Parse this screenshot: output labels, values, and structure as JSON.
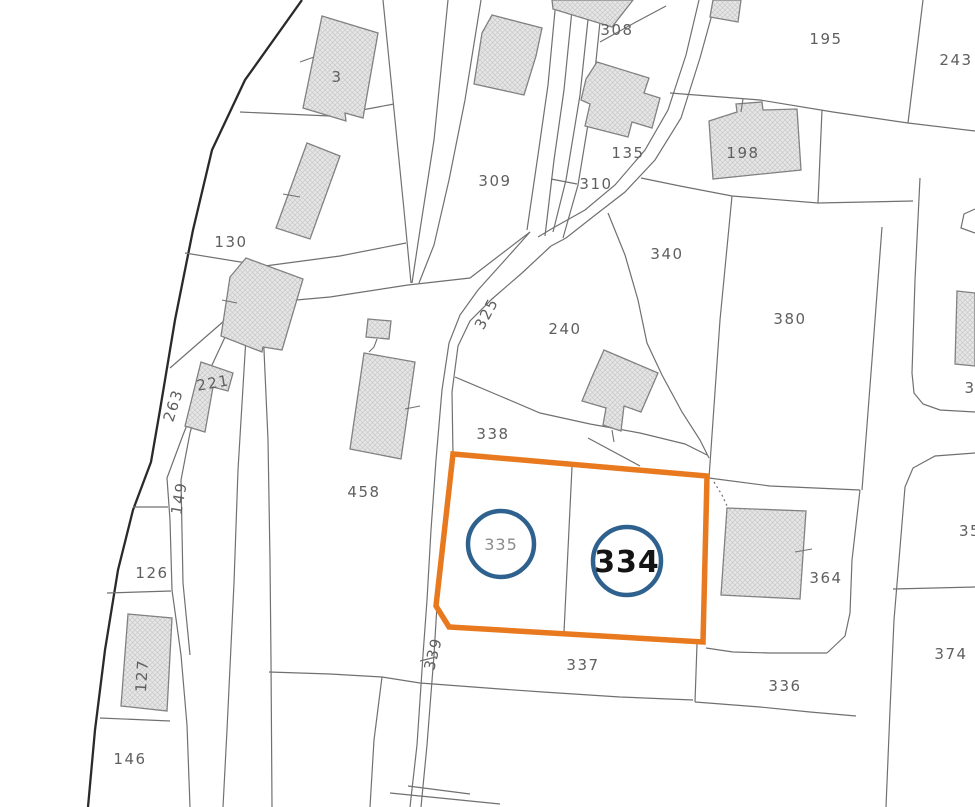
{
  "map": {
    "kind": "cadastral-parcel-map",
    "colors": {
      "background": "#ffffff",
      "parcel_line": "#707070",
      "outer_boundary": "#2a2a2a",
      "building_fill": "#e6e6e6",
      "building_hatch": "#c9c9c9",
      "building_stroke": "#818181",
      "label_gray": "#5f5f5f",
      "highlight_orange": "#e8791e",
      "circle_blue": "#2f618f"
    },
    "selection": {
      "primary_parcel": "334",
      "secondary_parcel": "335",
      "highlight_shape": "orange-boundary-polygon"
    },
    "parcel_labels": [
      {
        "text": "3",
        "x": 337,
        "y": 82,
        "rot": 0
      },
      {
        "text": "130",
        "x": 231,
        "y": 247,
        "rot": 0
      },
      {
        "text": "308",
        "x": 617,
        "y": 35,
        "rot": 0
      },
      {
        "text": "195",
        "x": 826,
        "y": 44,
        "rot": 0
      },
      {
        "text": "243",
        "x": 956,
        "y": 65,
        "rot": 0
      },
      {
        "text": "198",
        "x": 743,
        "y": 158,
        "rot": 0
      },
      {
        "text": "135",
        "x": 628,
        "y": 158,
        "rot": 0
      },
      {
        "text": "309",
        "x": 495,
        "y": 186,
        "rot": 0
      },
      {
        "text": "310",
        "x": 596,
        "y": 189,
        "rot": 0
      },
      {
        "text": "340",
        "x": 667,
        "y": 259,
        "rot": 0
      },
      {
        "text": "380",
        "x": 790,
        "y": 324,
        "rot": 0
      },
      {
        "text": "240",
        "x": 565,
        "y": 334,
        "rot": 0
      },
      {
        "text": "325",
        "x": 491,
        "y": 316,
        "rot": -62
      },
      {
        "text": "338",
        "x": 493,
        "y": 439,
        "rot": 0
      },
      {
        "text": "263",
        "x": 178,
        "y": 407,
        "rot": -72
      },
      {
        "text": "221",
        "x": 214,
        "y": 388,
        "rot": -10
      },
      {
        "text": "149",
        "x": 184,
        "y": 499,
        "rot": -80
      },
      {
        "text": "458",
        "x": 364,
        "y": 497,
        "rot": 0
      },
      {
        "text": "126",
        "x": 152,
        "y": 578,
        "rot": 0
      },
      {
        "text": "127",
        "x": 147,
        "y": 676,
        "rot": -86
      },
      {
        "text": "146",
        "x": 130,
        "y": 764,
        "rot": 0
      },
      {
        "text": "364",
        "x": 826,
        "y": 583,
        "rot": 0
      },
      {
        "text": "339",
        "x": 438,
        "y": 655,
        "rot": -76
      },
      {
        "text": "337",
        "x": 583,
        "y": 670,
        "rot": 0
      },
      {
        "text": "336",
        "x": 785,
        "y": 691,
        "rot": 0
      },
      {
        "text": "374",
        "x": 951,
        "y": 659,
        "rot": 0
      },
      {
        "text": "35",
        "x": 970,
        "y": 536,
        "rot": 0
      },
      {
        "text": "3",
        "x": 970,
        "y": 393,
        "rot": 0
      }
    ],
    "circled_labels": [
      {
        "text": "335",
        "cx": 501,
        "cy": 544,
        "r": 33,
        "style": "secondary"
      },
      {
        "text": "334",
        "cx": 627,
        "cy": 561,
        "r": 34,
        "style": "primary"
      }
    ]
  }
}
